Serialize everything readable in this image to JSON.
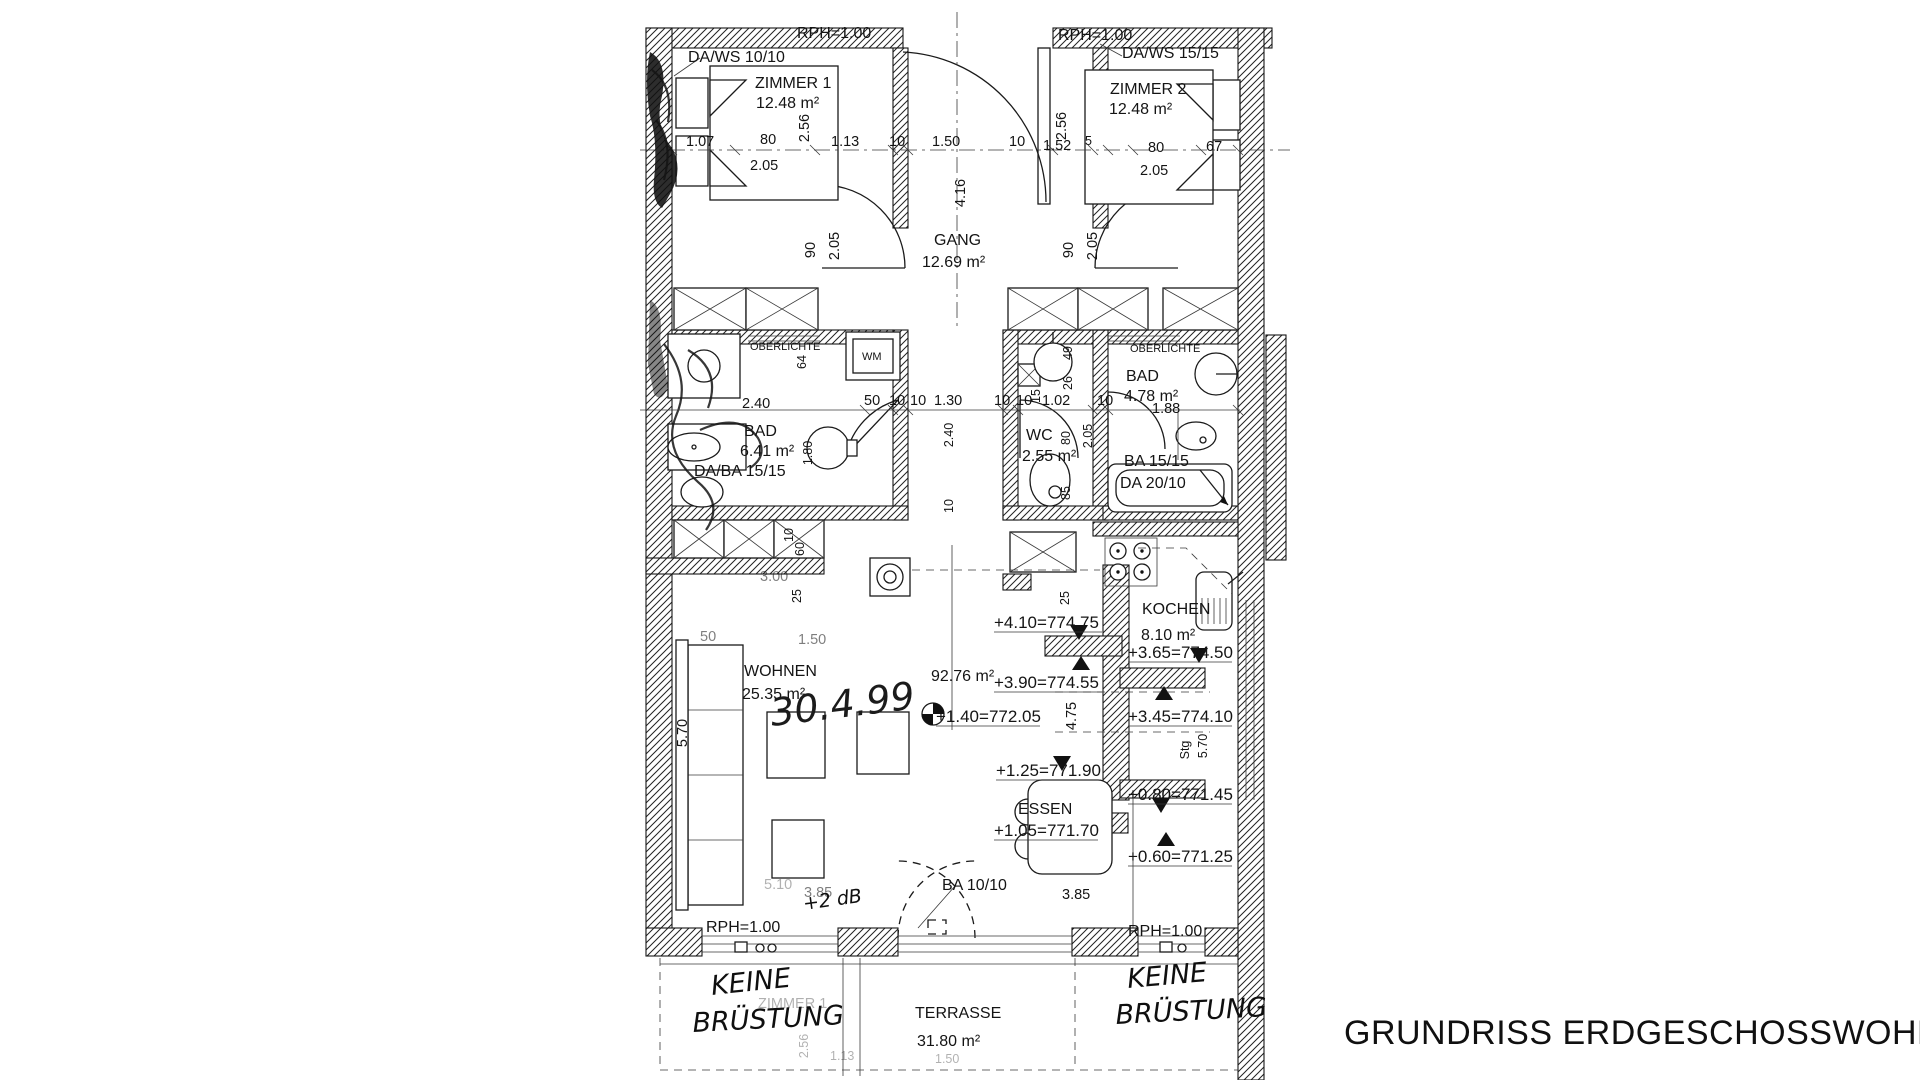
{
  "title": "GRUNDRISS ERDGESCHOSSWOHNUNG",
  "rooms": {
    "zimmer1": {
      "name": "ZIMMER 1",
      "area": "12.48 m²"
    },
    "zimmer2": {
      "name": "ZIMMER 2",
      "area": "12.48 m²"
    },
    "gang": {
      "name": "GANG",
      "area": "12.69 m²"
    },
    "bad1": {
      "name": "BAD",
      "area": "6.41 m²"
    },
    "wc": {
      "name": "WC",
      "area": "2.55 m²"
    },
    "bad2": {
      "name": "BAD",
      "area": "4.78 m²"
    },
    "wohnen": {
      "name": "WOHNEN",
      "area": "25.35 m²"
    },
    "kochen": {
      "name": "KOCHEN",
      "area": "8.10 m²"
    },
    "essen": {
      "name": "ESSEN"
    },
    "terrasse": {
      "name": "TERRASSE",
      "area": "31.80 m²"
    },
    "total_area": "92.76 m²"
  },
  "annotations": {
    "rph": "RPH=1.00",
    "da_ws_1": "DA/WS 10/10",
    "da_ws_2": "DA/WS 15/15",
    "da_ba": "DA/BA 15/15",
    "ba_15": "BA 15/15",
    "da_20": "DA 20/10",
    "ba_10": "BA 10/10",
    "oberlichte": "OBERLICHTE",
    "wm": "WM",
    "stg": "Stg"
  },
  "levels": {
    "left": [
      "+4.10=774.75",
      "+3.90=774.55",
      "+1.40=772.05",
      "+1.25=771.90",
      "+1.05=771.70"
    ],
    "right": [
      "+3.65=774.50",
      "+3.45=774.10",
      "+0.80=771.45",
      "+0.60=771.25"
    ]
  },
  "dims": {
    "row1": [
      "1.07",
      "80",
      "2.05",
      "1.13",
      "10",
      "1.50",
      "10",
      "1.52",
      "5",
      "80",
      "2.05",
      "67"
    ],
    "row2": [
      "2.40",
      "50",
      "10",
      "10",
      "1.30",
      "10",
      "10",
      "1.02",
      "10",
      "1.88"
    ],
    "vert": {
      "z1": "2.56",
      "z2": "2.56",
      "gang": "4.16",
      "d90": "90",
      "d205": "2.05",
      "v64": "64",
      "v49": "49",
      "v26": "26",
      "v15": "15",
      "v80": "80",
      "v85": "85",
      "v240": "2.40",
      "v10": "10",
      "v180": "1.80",
      "s10": "10",
      "s60": "60",
      "s25": "25",
      "w570": "5.70",
      "k475": "4.75",
      "k25": "25",
      "k570": "5.70"
    },
    "low": {
      "d300": "3.00",
      "d150": "1.50",
      "d50": "50",
      "d385a": "3.85",
      "d385b": "3.85",
      "d510": "5.10"
    }
  },
  "handwritten": {
    "keine": "KEINE",
    "bruestung": "BRÜSTUNG",
    "date": "30.4.99",
    "db": "+2 dB"
  },
  "ghost": {
    "zimmer": "ZIMMER 1",
    "g256": "2.56",
    "g113": "1.13",
    "g150": "1.50"
  }
}
